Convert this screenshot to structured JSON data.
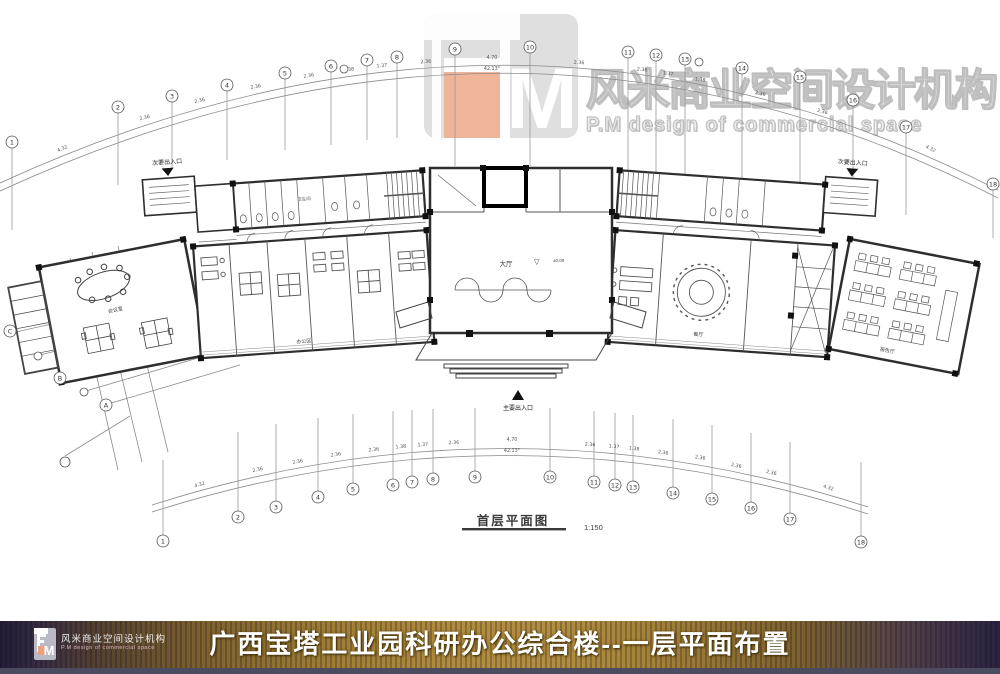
{
  "watermark": {
    "company_cn": "风米商业空间设计机构",
    "company_en": "P.M design of commercial space",
    "logo_letter": "M"
  },
  "plan": {
    "caption": "首层平面图",
    "scale": "1:150",
    "entrances": {
      "main": "主要出入口",
      "secondary_left": "次要出入口",
      "secondary_right": "次要出入口"
    },
    "rooms": {
      "lobby": "大厅",
      "level": "±0.00",
      "office": "办公区",
      "meeting": "会议室",
      "dining": "餐厅",
      "lecture": "报告厅",
      "toilet": "卫生间"
    },
    "axes": {
      "top": [
        "1",
        "2",
        "3",
        "4",
        "5",
        "6",
        "7",
        "8",
        "9",
        "10",
        "11",
        "12",
        "13",
        "14",
        "15",
        "16",
        "17",
        "18"
      ],
      "bottom": [
        "1",
        "2",
        "3",
        "4",
        "5",
        "6",
        "7",
        "8",
        "9",
        "10",
        "11",
        "12",
        "13",
        "14",
        "15",
        "16",
        "17",
        "18"
      ],
      "left": [
        "C",
        "B",
        "A"
      ]
    },
    "dims": {
      "end": "4.32",
      "bay": "2.36",
      "half_a": "1.38",
      "half_b": "1.37",
      "center": "4.70",
      "angle": "42.13°"
    }
  },
  "footer": {
    "title": "广西宝塔工业园科研办公综合楼--一层平面布置",
    "logo_cn": "风米商业空间设计机构",
    "logo_en": "P.M design of commercial space",
    "logo_letter": "M"
  }
}
